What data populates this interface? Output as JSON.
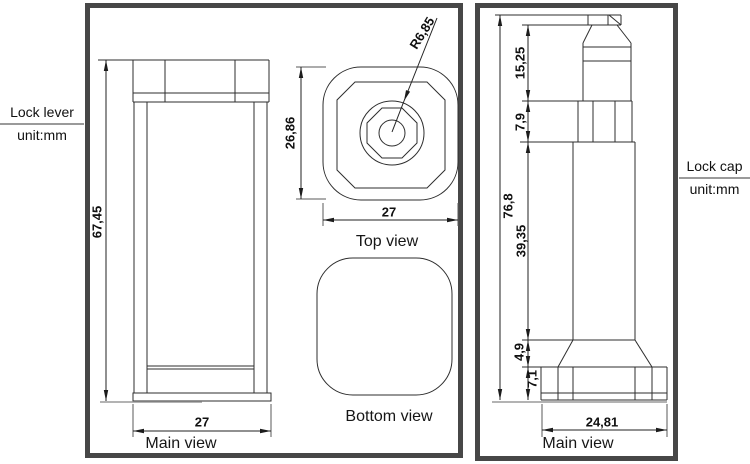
{
  "side_labels": {
    "left": {
      "title": "Lock lever",
      "unit": "unit:mm"
    },
    "right": {
      "title": "Lock cap",
      "unit": "unit:mm"
    }
  },
  "lock_lever": {
    "main_view": {
      "label": "Main view",
      "dim_height": "67,45",
      "dim_width": "27"
    },
    "top_view": {
      "label": "Top view",
      "dim_height": "26,86",
      "dim_width": "27",
      "dim_radius": "R6,85"
    },
    "bottom_view": {
      "label": "Bottom view"
    }
  },
  "lock_cap": {
    "main_view": {
      "label": "Main view",
      "dim_total_height": "76,8",
      "dim_top_section": "15,25",
      "dim_collar": "7,9",
      "dim_shaft": "39,35",
      "dim_flare": "4,9",
      "dim_base": "7,1",
      "dim_base_width": "24,81"
    }
  }
}
